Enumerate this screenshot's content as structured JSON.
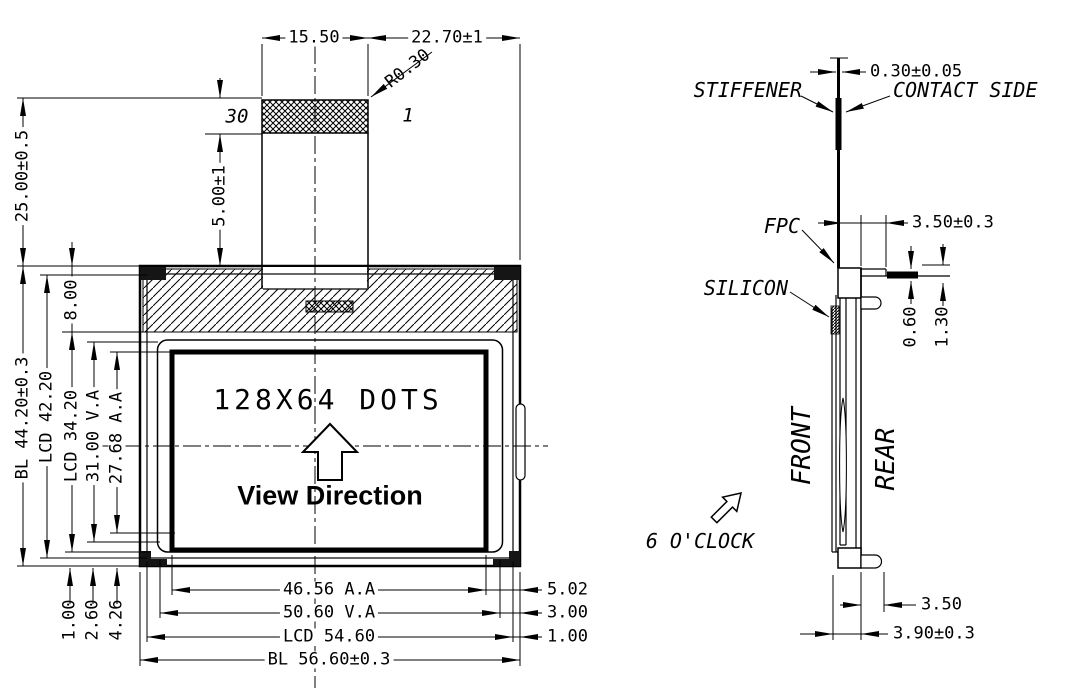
{
  "front_view": {
    "display": {
      "dots_text": "128X64 DOTS",
      "view_direction": "View Direction"
    },
    "connector": {
      "pin_left": "30",
      "pin_right": "1"
    },
    "dimensions": {
      "tail_width": "15.50",
      "tail_to_edge": "22.70±1",
      "corner_radius": "R0.30",
      "tail_length": "25.00±0.5",
      "stiffener": "5.00±1",
      "top_frame": "8.00",
      "height_bl": "BL 44.20±0.3",
      "height_lcd": "LCD 42.20",
      "height_lcd_inner": "LCD 34.20",
      "height_va": "31.00 V.A",
      "height_aa": "27.68 A.A",
      "bottom_left_1": "1.00",
      "bottom_left_2": "2.60",
      "bottom_left_3": "4.26",
      "width_aa": "46.56 A.A",
      "width_va": "50.60 V.A",
      "width_lcd": "LCD 54.60",
      "width_bl": "BL 56.60±0.3",
      "right_1": "5.02",
      "right_2": "3.00",
      "right_3": "1.00"
    }
  },
  "side_view": {
    "labels": {
      "stiffener": "STIFFENER",
      "contact_side": "CONTACT SIDE",
      "fpc": "FPC",
      "silicon": "SILICON",
      "front": "FRONT",
      "rear": "REAR",
      "clock": "6 O'CLOCK"
    },
    "dimensions": {
      "fpc_thickness": "0.30±0.05",
      "top_width": "3.50±0.3",
      "ledge": "0.60",
      "tab_gap": "1.30",
      "bottom_tab": "3.50",
      "thickness": "3.90±0.3"
    }
  }
}
